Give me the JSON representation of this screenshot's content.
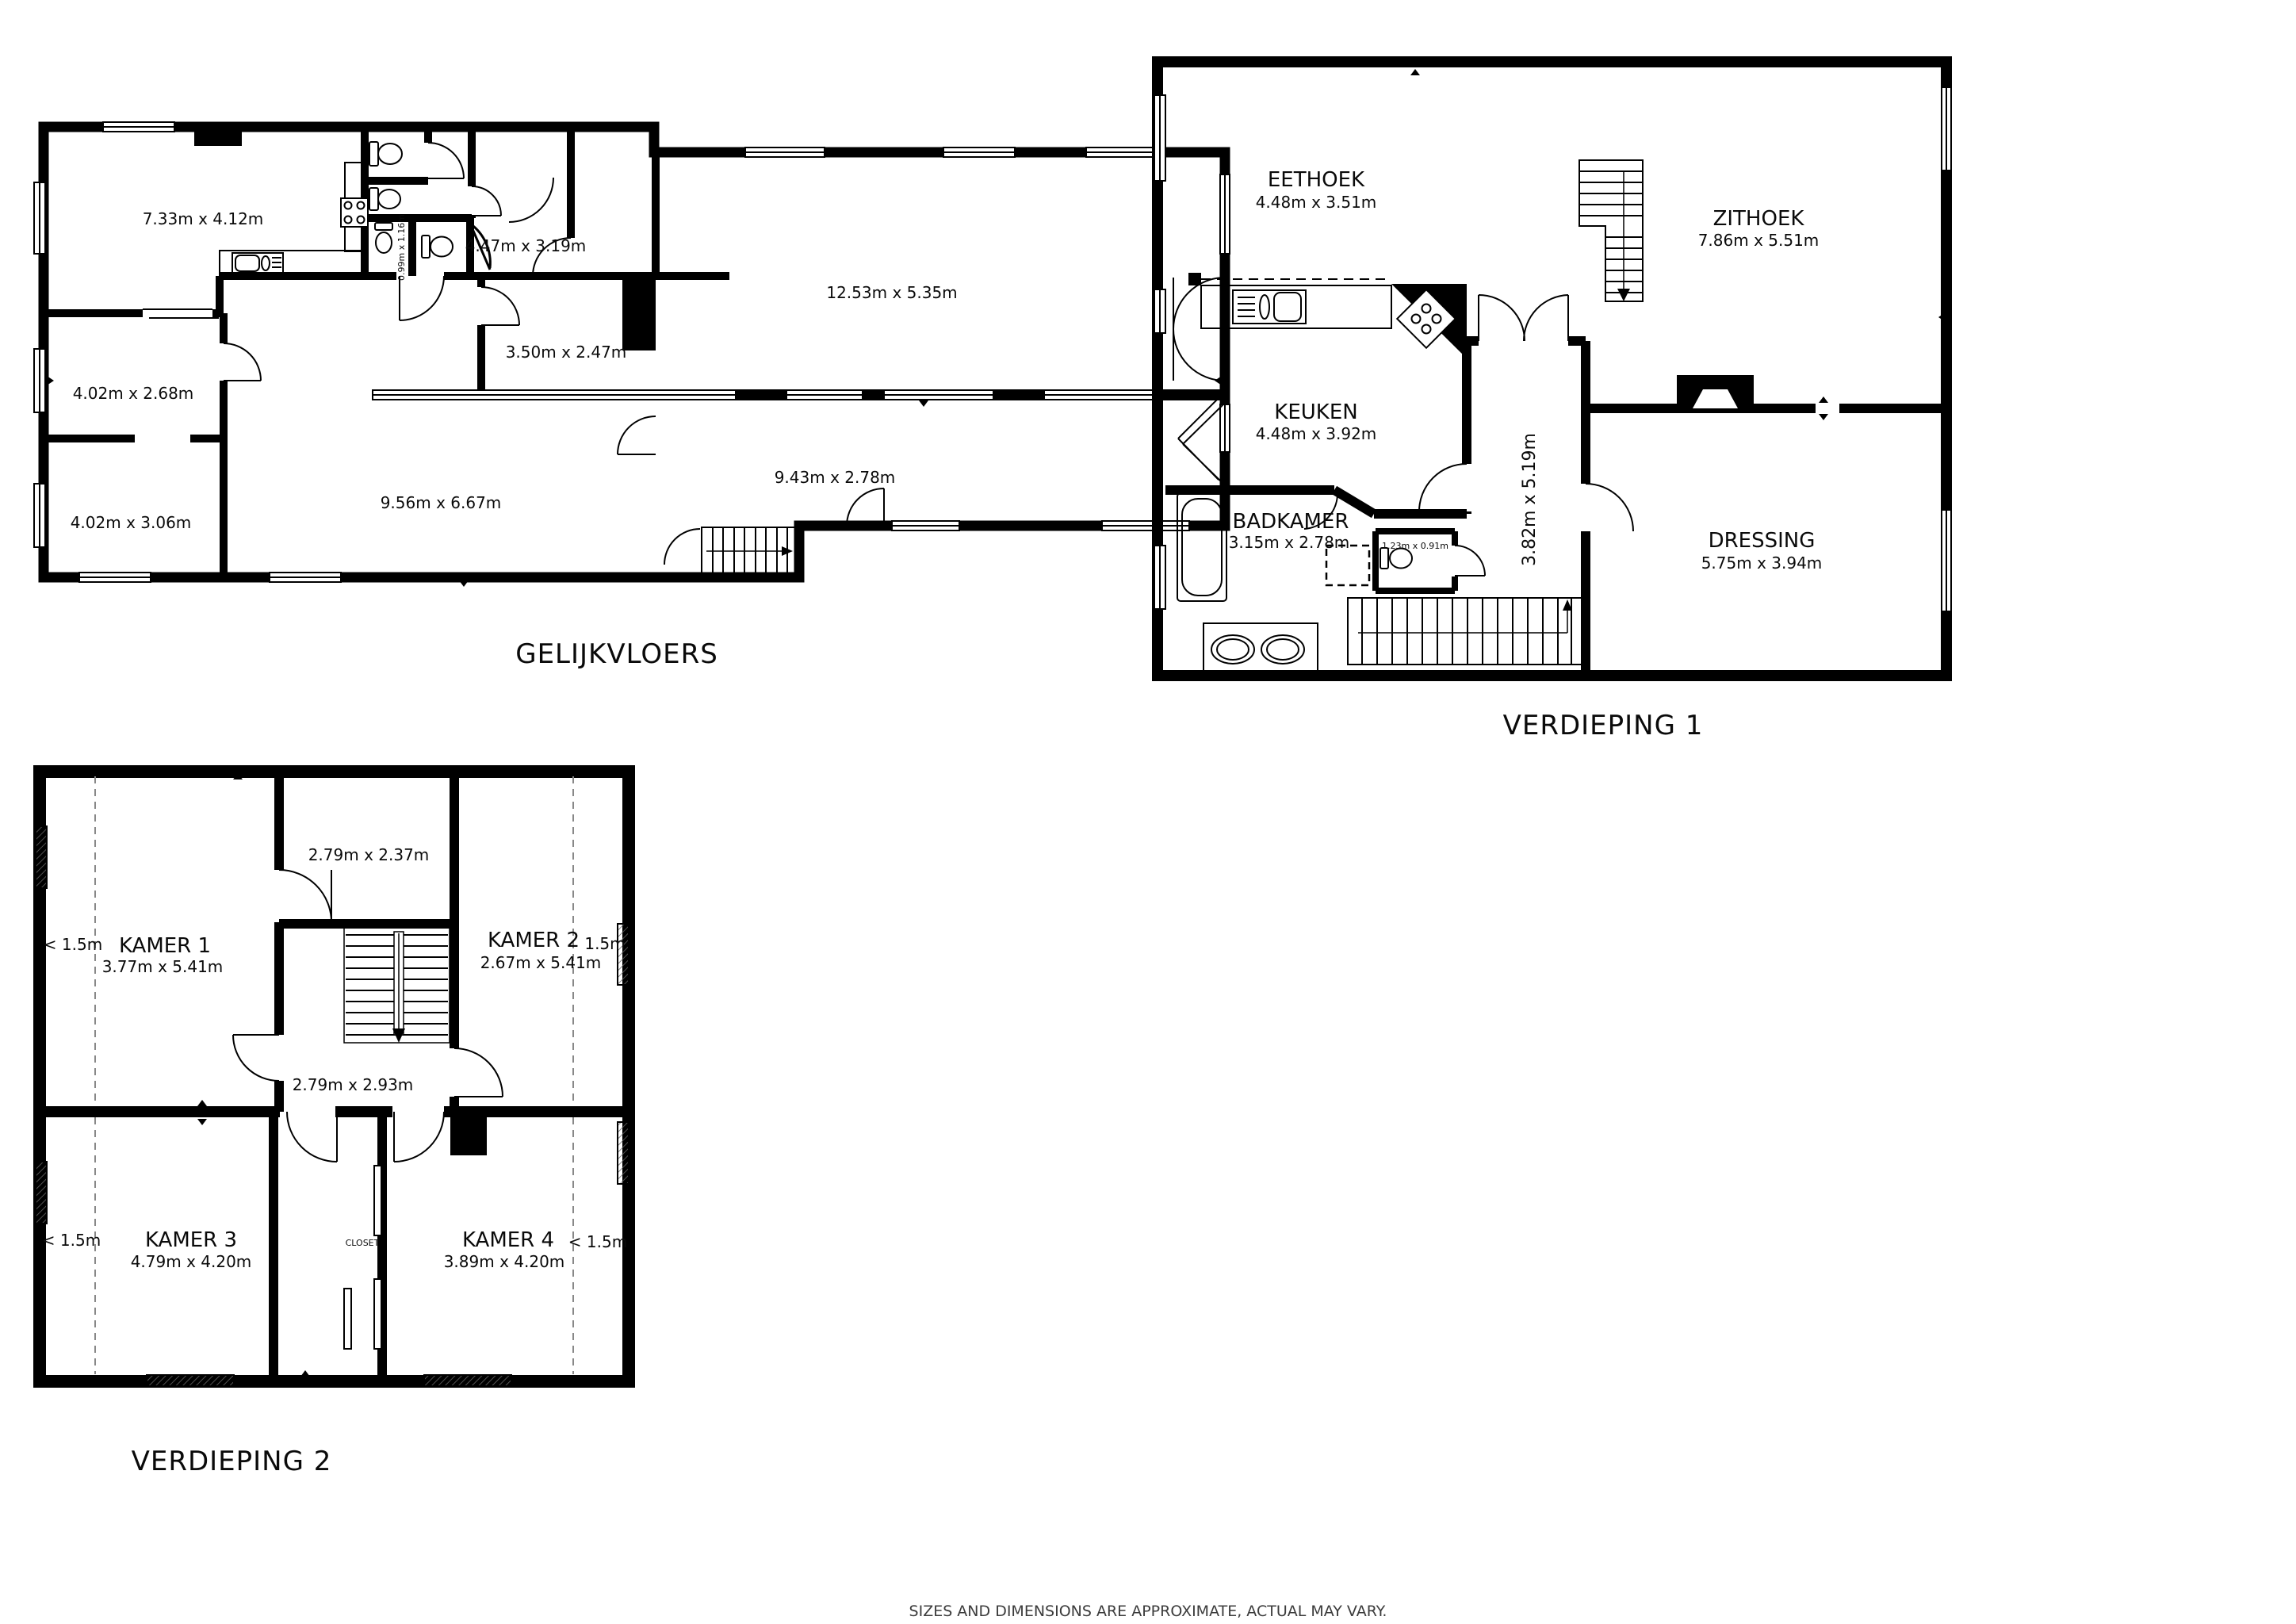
{
  "disclaimer": "SIZES AND DIMENSIONS ARE APPROXIMATE, ACTUAL MAY VARY.",
  "floors": {
    "gf": {
      "title": "GELIJKVLOERS",
      "rooms": {
        "kitchen_dining": {
          "dims": "7.33m x 4.12m"
        },
        "wc_small": {
          "dims": "0.99m x 1.16m"
        },
        "hall": {
          "dims": "4.47m x 3.19m"
        },
        "storage": {
          "dims": "3.50m x 2.47m"
        },
        "front_room_1": {
          "dims": "4.02m x 2.68m"
        },
        "front_room_2": {
          "dims": "4.02m x 3.06m"
        },
        "living": {
          "dims": "9.56m x 6.67m"
        },
        "great_room": {
          "dims": "12.53m x 5.35m"
        },
        "corridor": {
          "dims": "9.43m x 2.78m"
        }
      }
    },
    "v1": {
      "title": "VERDIEPING 1",
      "rooms": {
        "eethoek": {
          "name": "EETHOEK",
          "dims": "4.48m x 3.51m"
        },
        "zithoek": {
          "name": "ZITHOEK",
          "dims": "7.86m x 5.51m"
        },
        "keuken": {
          "name": "KEUKEN",
          "dims": "4.48m x 3.92m"
        },
        "badkamer": {
          "name": "BADKAMER",
          "dims": "3.15m x 2.78m"
        },
        "wc": {
          "dims": "1.23m x 0.91m"
        },
        "hal": {
          "dims": "3.82m x 5.19m"
        },
        "dressing": {
          "name": "DRESSING",
          "dims": "5.75m x 3.94m"
        }
      }
    },
    "v2": {
      "title": "VERDIEPING 2",
      "rooms": {
        "kamer1": {
          "name": "KAMER 1",
          "dims": "3.77m x 5.41m"
        },
        "kamer2": {
          "name": "KAMER 2",
          "dims": "2.67m x 5.41m"
        },
        "kamer3": {
          "name": "KAMER 3",
          "dims": "4.79m x 4.20m"
        },
        "kamer4": {
          "name": "KAMER 4",
          "dims": "3.89m x 4.20m"
        },
        "top_room": {
          "dims": "2.79m x 2.37m"
        },
        "hall": {
          "dims": "2.79m x 2.93m"
        },
        "closet": {
          "name": "CLOSET"
        }
      },
      "markers": {
        "k1": "< 1.5m",
        "k2": "1.5m",
        "k3": "< 1.5m",
        "k4": "< 1.5m"
      }
    }
  }
}
